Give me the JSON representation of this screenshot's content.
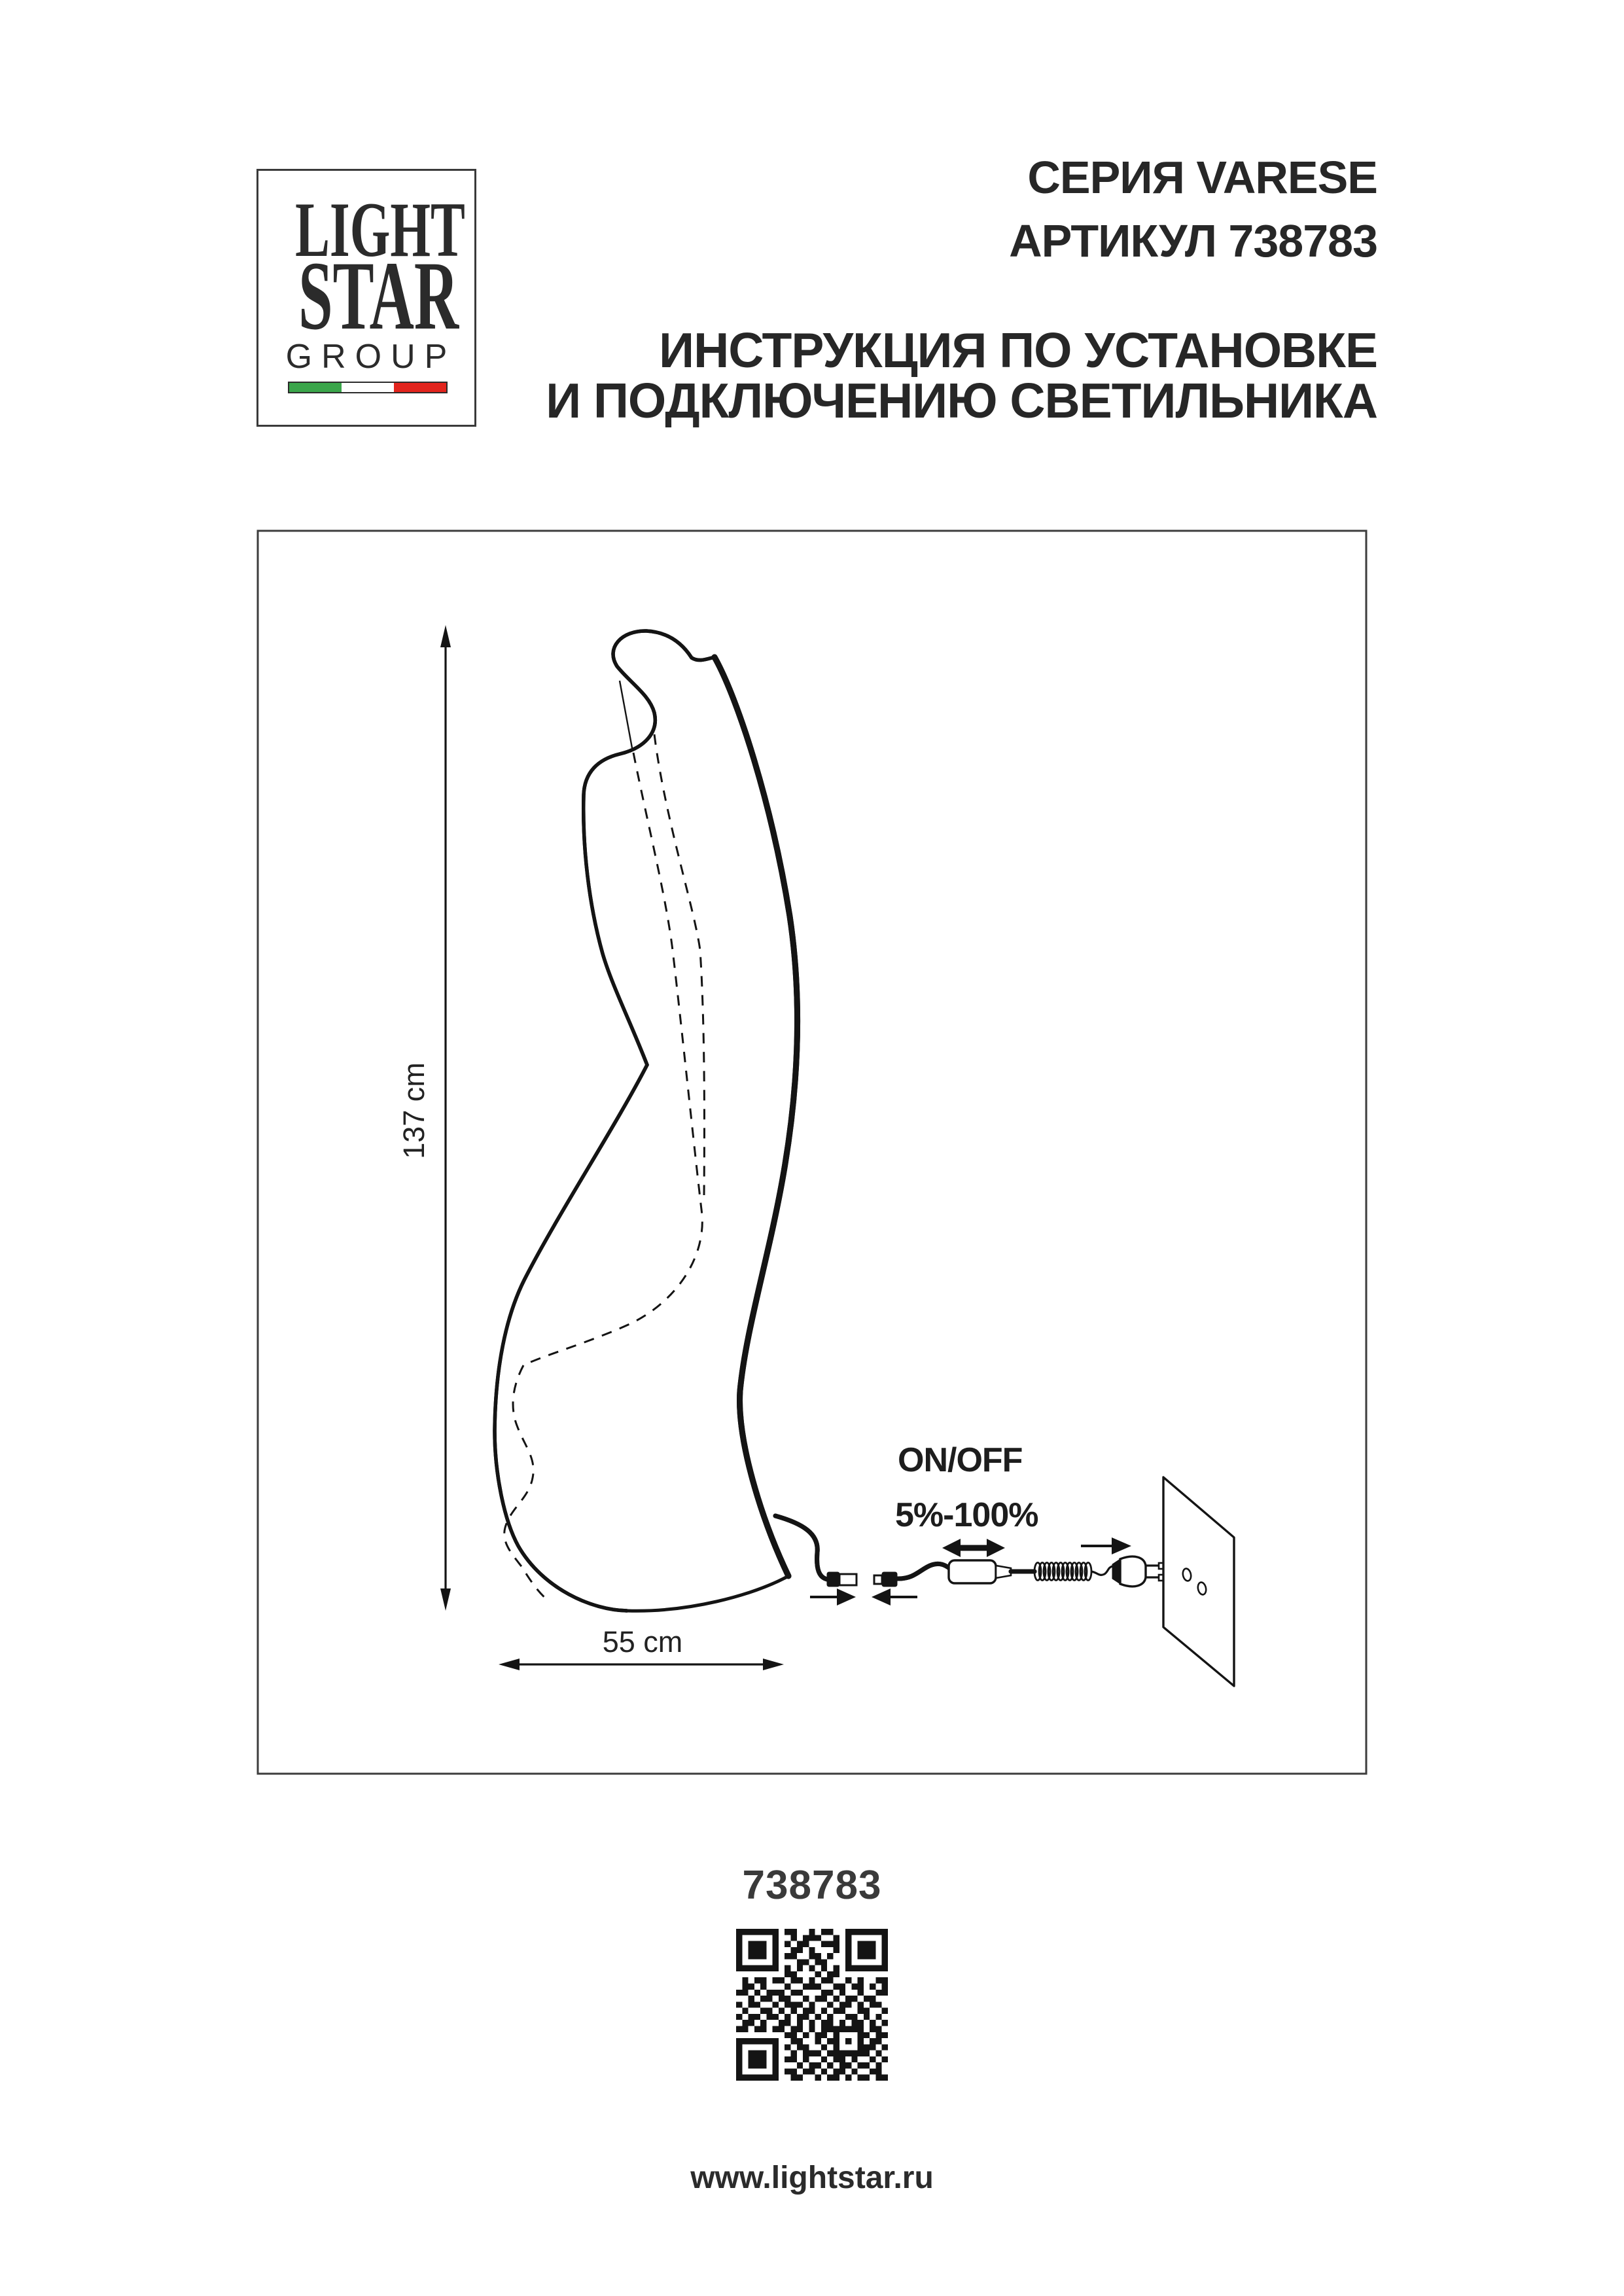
{
  "logo": {
    "line1": "LIGHT",
    "line2": "STAR",
    "line3": "GROUP",
    "flag_colors": {
      "green": "#3aa54a",
      "white": "#ffffff",
      "red": "#e2241d"
    }
  },
  "header": {
    "series": "СЕРИЯ VARESE",
    "article": "АРТИКУЛ 738783",
    "instruction_line1": "ИНСТРУКЦИЯ ПО УСТАНОВКЕ",
    "instruction_line2": "И ПОДКЛЮЧЕНИЮ СВЕТИЛЬНИКА"
  },
  "diagram": {
    "height_label": "137 cm",
    "width_label": "55 cm",
    "switch_label": "ON/OFF",
    "dim_range_label": "5%-100%"
  },
  "footer": {
    "article_number": "738783",
    "website": "www.lightstar.ru"
  },
  "qr": {
    "matrix": [
      "1111111011001011001111111",
      "1000001001011100101000001",
      "1011101010110011101011101",
      "1011101001101000101011101",
      "1011101011001101001011101",
      "1000001000110110001000001",
      "1111111010101010101111111",
      "0000000011000101100000000",
      "0101101101101011001010011",
      "0110100010011100110110101",
      "1101011101100011010010011",
      "0010110110010110101101100",
      "1011001011101001011010110",
      "0100110101011010110011001",
      "1011011010110101001101010",
      "0110100110101011010110101",
      "1101101101101011111110110",
      "0000000011010110100011011",
      "1111111001100101101010110",
      "1000001010110010100011101",
      "1011101001011101111111010",
      "1011101011010010110100101",
      "1011101000101101011011010",
      "1000001011011010110100110",
      "1111111001100101101011011"
    ]
  },
  "colors": {
    "ink": "#141414",
    "frame": "#3d3d3d",
    "header_text": "#272727",
    "article_text": "#3a3a3a"
  }
}
